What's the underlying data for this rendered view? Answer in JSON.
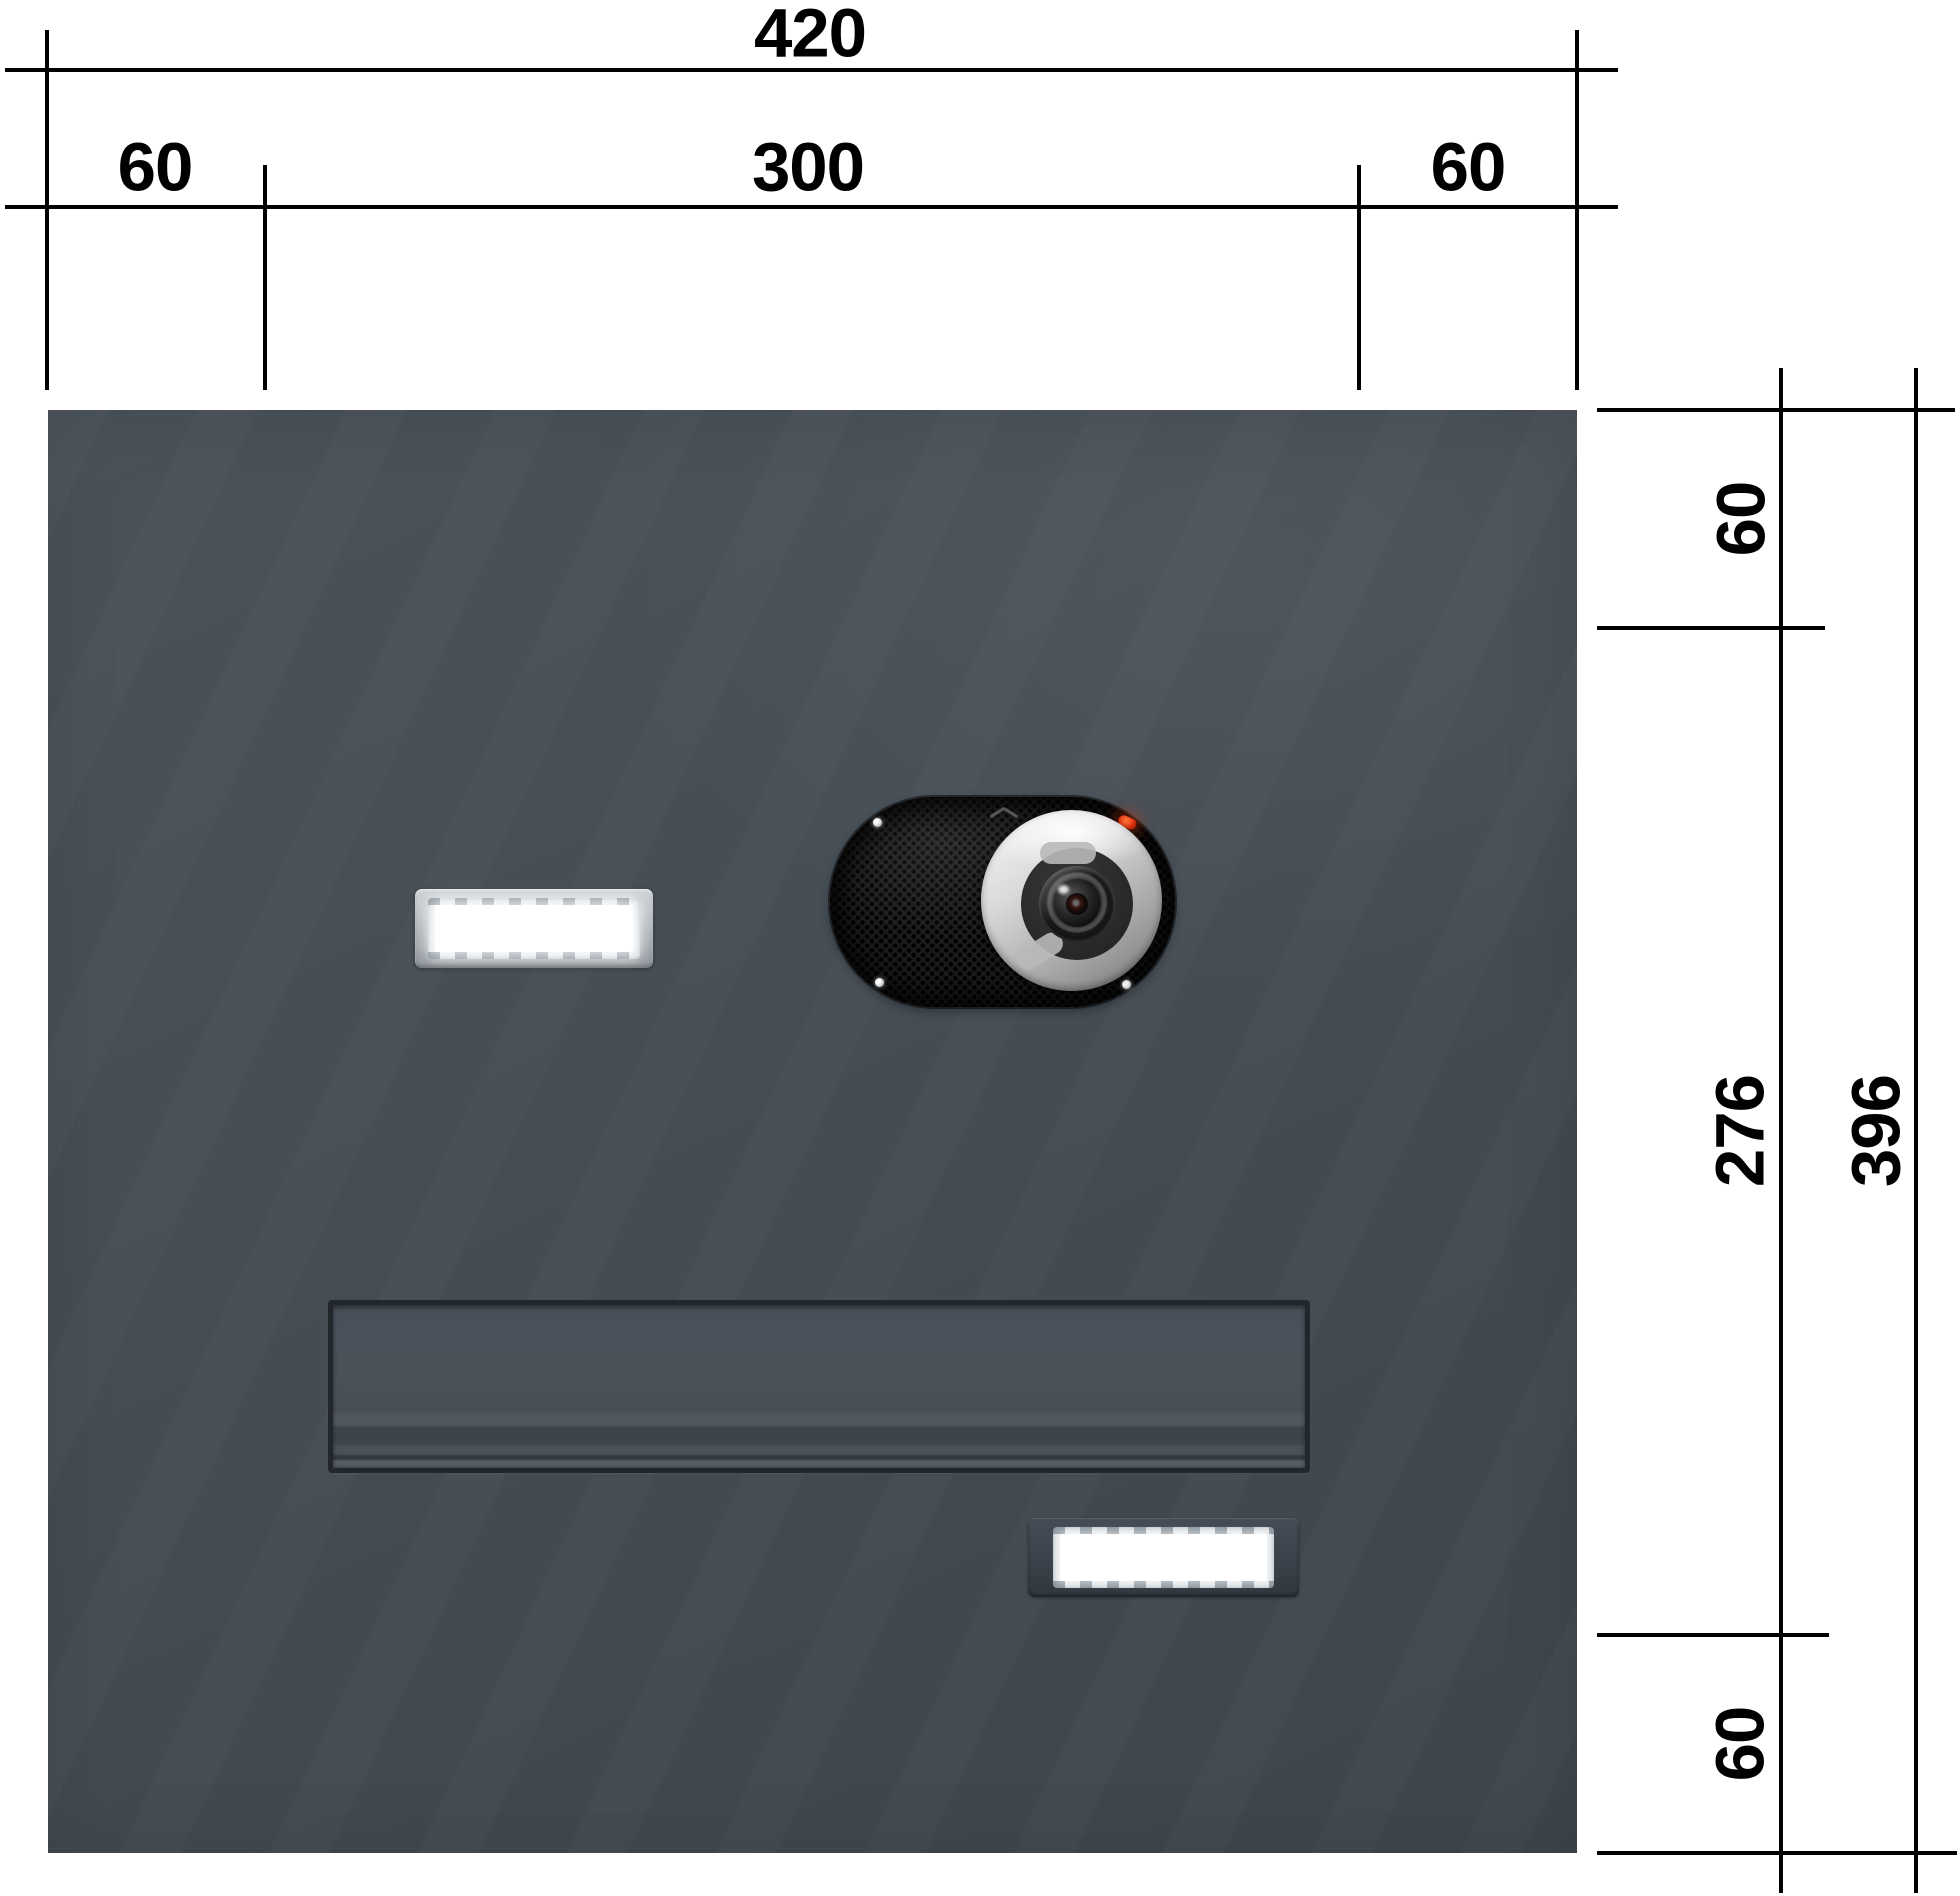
{
  "meta": {
    "width_px": 1960,
    "height_px": 1896,
    "background": "#ffffff",
    "drawing_type": "technical dimension drawing",
    "subject": "letterbox / video intercom front panel"
  },
  "colors": {
    "dimension_lines": "#000000",
    "panel_anthracite": "#454d54",
    "nameplate_frame_silver": "#b7bcc0",
    "nameplate_frame_dark": "#3a434b",
    "camera_body_black": "#1c1c1c",
    "led_red": "#e5330f",
    "window_white": "#ffffff"
  },
  "dimensions": {
    "top": {
      "total": "420",
      "segments": [
        "60",
        "300",
        "60"
      ]
    },
    "right": {
      "segments": [
        "60",
        "276",
        "60"
      ],
      "total": "396"
    }
  },
  "components": {
    "bell_button": "illuminated nameplate bell button",
    "camera_module": "camera / speaker module with red status LED",
    "letter_flap": "letter slot flap",
    "nameplate": "nameplate holder"
  }
}
